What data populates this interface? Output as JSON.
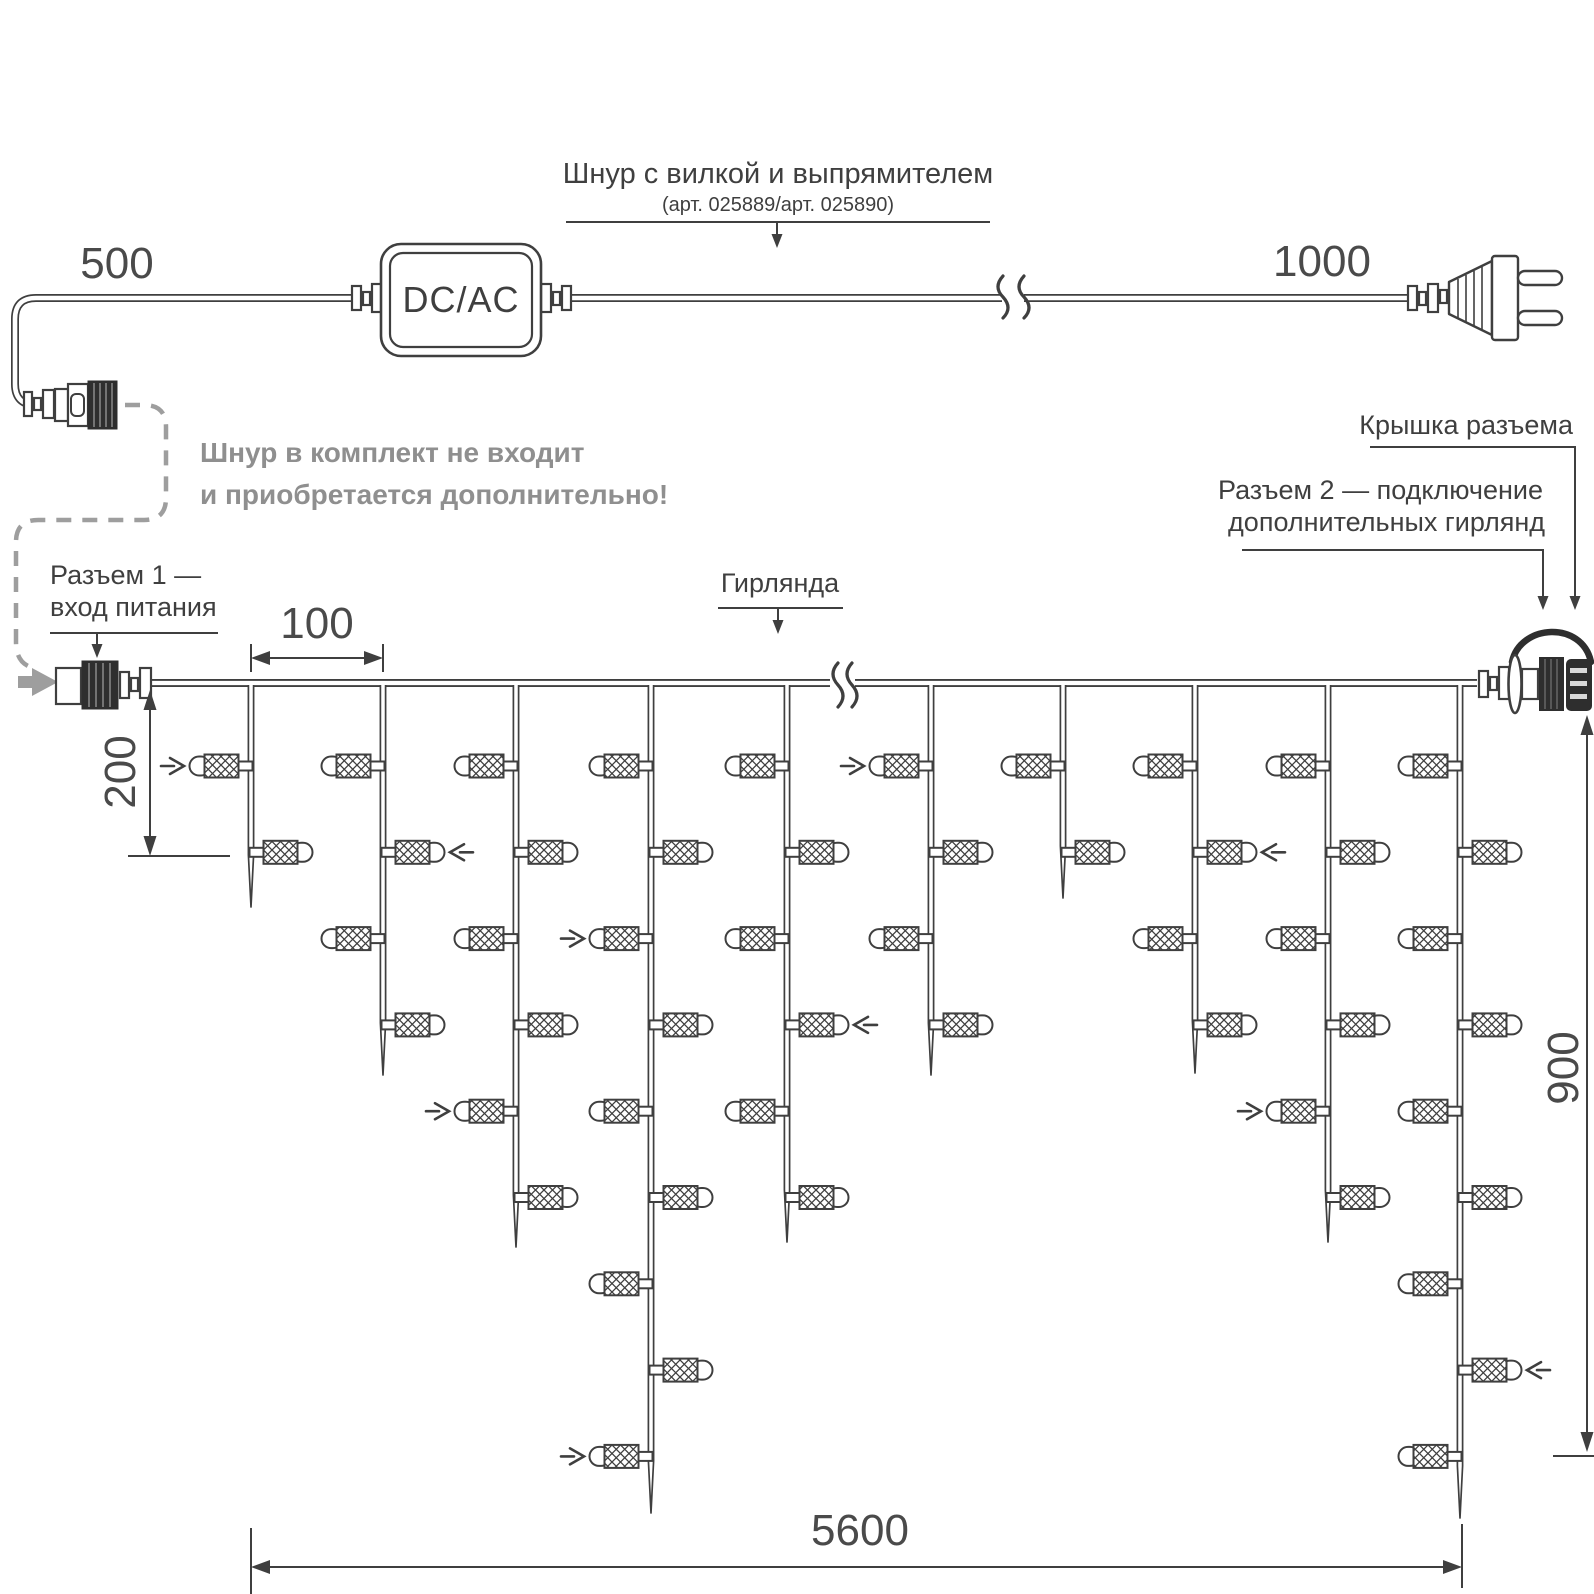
{
  "colors": {
    "line": "#3f3f3f",
    "dark_fill": "#2e2e2e",
    "muted_text": "#8f8f8f",
    "dashed_gray": "#9e9e9e",
    "background": "#ffffff"
  },
  "cord_assembly": {
    "label": "Шнур с вилкой и выпрямителем",
    "sublabel": "(арт. 025889/арт. 025890)",
    "dim_left": "500",
    "dim_right": "1000",
    "converter_label": "DC/AC"
  },
  "note": {
    "line1": "Шнур в комплект не входит",
    "line2": "и приобретается дополнительно!"
  },
  "callouts": {
    "connector1_line1": "Разъем 1 —",
    "connector1_line2": "вход питания",
    "garland": "Гирлянда",
    "connector_cap": "Крышка разъема",
    "connector2_line1": "Разъем 2 — подключение",
    "connector2_line2": "дополнительных гирлянд"
  },
  "dimensions": {
    "drop_spacing": "100",
    "first_drop_length": "200",
    "garland_height": "900",
    "garland_length": "5600"
  },
  "garland": {
    "wire_y": 683,
    "wire_x_start": 148,
    "wire_x_end": 1477,
    "wire_break_x": 842,
    "level_first_y": 766,
    "level_spacing": 86.3,
    "strands": [
      {
        "x": 251,
        "bulbs": 2,
        "tip_y": 907
      },
      {
        "x": 383,
        "bulbs": 4,
        "tip_y": 1075
      },
      {
        "x": 516,
        "bulbs": 6,
        "tip_y": 1247
      },
      {
        "x": 651,
        "bulbs": 9,
        "tip_y": 1513
      },
      {
        "x": 787,
        "bulbs": 6,
        "tip_y": 1242
      },
      {
        "x": 931,
        "bulbs": 4,
        "tip_y": 1075
      },
      {
        "x": 1063,
        "bulbs": 2,
        "tip_y": 898
      },
      {
        "x": 1195,
        "bulbs": 4,
        "tip_y": 1073
      },
      {
        "x": 1328,
        "bulbs": 6,
        "tip_y": 1242
      },
      {
        "x": 1460,
        "bulbs": 9,
        "tip_y": 1518
      }
    ],
    "markers": [
      {
        "strand": 0,
        "level": 0
      },
      {
        "strand": 1,
        "level": 1
      },
      {
        "strand": 2,
        "level": 4
      },
      {
        "strand": 3,
        "level": 2
      },
      {
        "strand": 3,
        "level": 8
      },
      {
        "strand": 4,
        "level": 3
      },
      {
        "strand": 5,
        "level": 0
      },
      {
        "strand": 7,
        "level": 1
      },
      {
        "strand": 8,
        "level": 4
      },
      {
        "strand": 9,
        "level": 7
      }
    ]
  }
}
